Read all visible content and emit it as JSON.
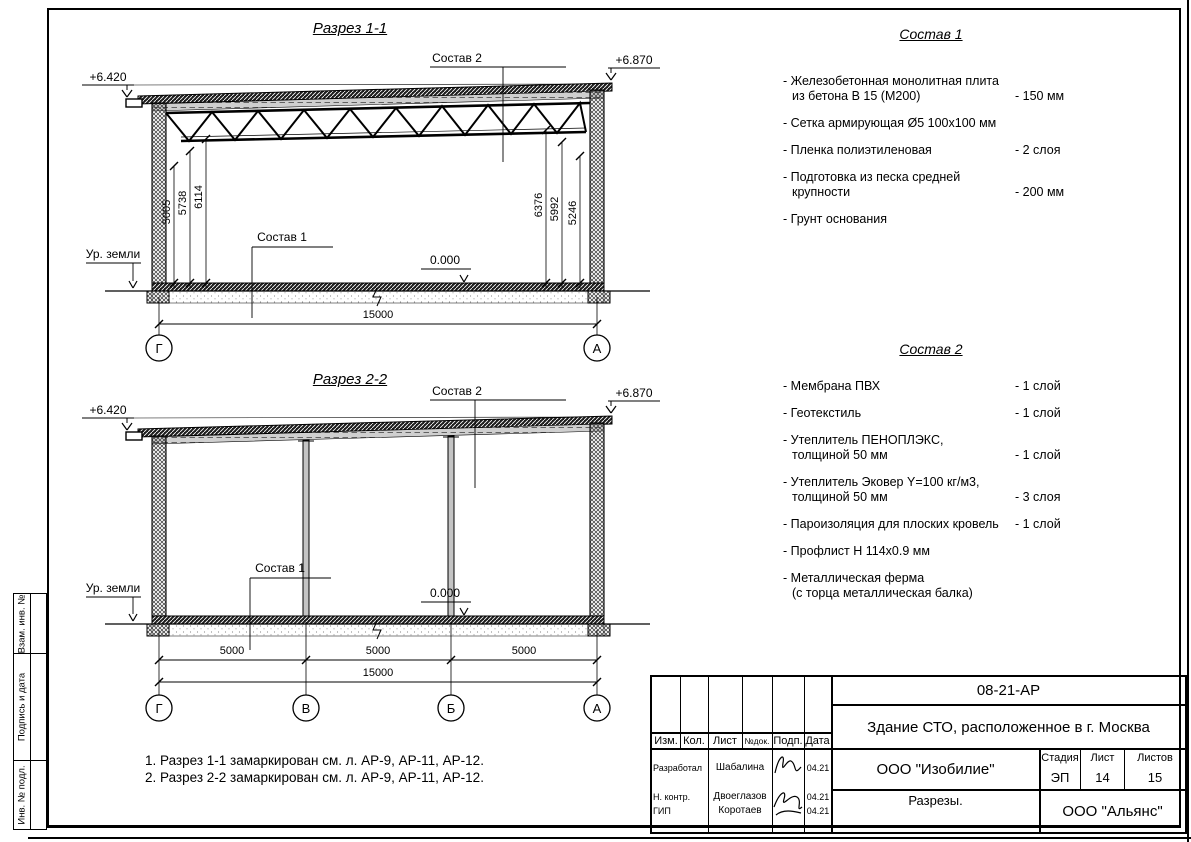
{
  "frame_strip": {
    "labels": [
      "Взам. инв. №",
      "Подпись и дата",
      "Инв. № подл."
    ]
  },
  "section1": {
    "title": "Разрез 1-1",
    "elev_left": "+6.420",
    "elev_right": "+6.870",
    "ground_label": "Ур. земли",
    "zero_level": "0.000",
    "callout_top": "Состав 2",
    "callout_floor": "Состав 1",
    "dims_left": [
      "5005",
      "5738",
      "6114"
    ],
    "dims_right": [
      "6376",
      "5992",
      "5246"
    ],
    "dim_total": "15000",
    "axis_left": "Г",
    "axis_right": "А"
  },
  "section2": {
    "title": "Разрез 2-2",
    "elev_left": "+6.420",
    "elev_right": "+6.870",
    "ground_label": "Ур. земли",
    "zero_level": "0.000",
    "callout_top": "Состав 2",
    "callout_floor": "Состав 1",
    "spans": [
      "5000",
      "5000",
      "5000"
    ],
    "dim_total": "15000",
    "axes": [
      "Г",
      "В",
      "Б",
      "А"
    ]
  },
  "sostav1": {
    "title": "Состав 1",
    "items": [
      {
        "line1": "- Железобетонная  монолитная плита",
        "line2": "из бетона В 15 (М200)",
        "value": "- 150 мм"
      },
      {
        "line1": "- Сетка армирующая Ø5 100x100 мм",
        "value": ""
      },
      {
        "line1": "- Пленка полиэтиленовая",
        "value": "-  2 слоя"
      },
      {
        "line1": "- Подготовка из песка средней",
        "line2": "крупности",
        "value": "- 200 мм"
      },
      {
        "line1": "- Грунт основания",
        "value": ""
      }
    ]
  },
  "sostav2": {
    "title": "Состав 2",
    "items": [
      {
        "line1": "- Мембрана ПВХ",
        "value": "- 1 слой"
      },
      {
        "line1": "- Геотекстиль",
        "value": "- 1 слой"
      },
      {
        "line1": "- Утеплитель ПЕНОПЛЭКС,",
        "line2": "толщиной 50 мм",
        "value": "- 1 слой"
      },
      {
        "line1": "- Утеплитель Эковер Y=100 кг/м3,",
        "line2": "толщиной 50 мм",
        "value": "- 3 слоя"
      },
      {
        "line1": "- Пароизоляция для плоских кровель",
        "value": "- 1 слой"
      },
      {
        "line1": "- Профлист Н 114x0.9 мм",
        "value": ""
      },
      {
        "line1": "- Металлическая ферма",
        "line2": "(с торца металлическая балка)",
        "value": ""
      }
    ]
  },
  "notes": [
    "1. Разрез 1-1 замаркирован см. л. АР-9, АР-11, АР-12.",
    "2. Разрез 2-2 замаркирован см. л. АР-9, АР-11, АР-12."
  ],
  "title_block": {
    "doc_number": "08-21-АР",
    "project_title": "Здание СТО, расположенное в г. Москва",
    "designer_org": "ООО \"Изобилие\"",
    "sheet_name": "Разрезы.",
    "client_org": "ООО \"Альянс\"",
    "stage_label": "Стадия",
    "sheet_label": "Лист",
    "sheets_label": "Листов",
    "stage_value": "ЭП",
    "sheet_value": "14",
    "sheets_value": "15",
    "rev_headers": [
      "Изм.",
      "Кол.",
      "Лист",
      "№док.",
      "Подп.",
      "Дата"
    ],
    "signatories": [
      {
        "role": "Разработал",
        "name": "Шабалина",
        "date": "04.21"
      },
      {
        "role": "Н. контр.",
        "name": "Двоеглазов",
        "date": "04.21"
      },
      {
        "role": "ГИП",
        "name": "Коротаев",
        "date": "04.21"
      }
    ]
  }
}
